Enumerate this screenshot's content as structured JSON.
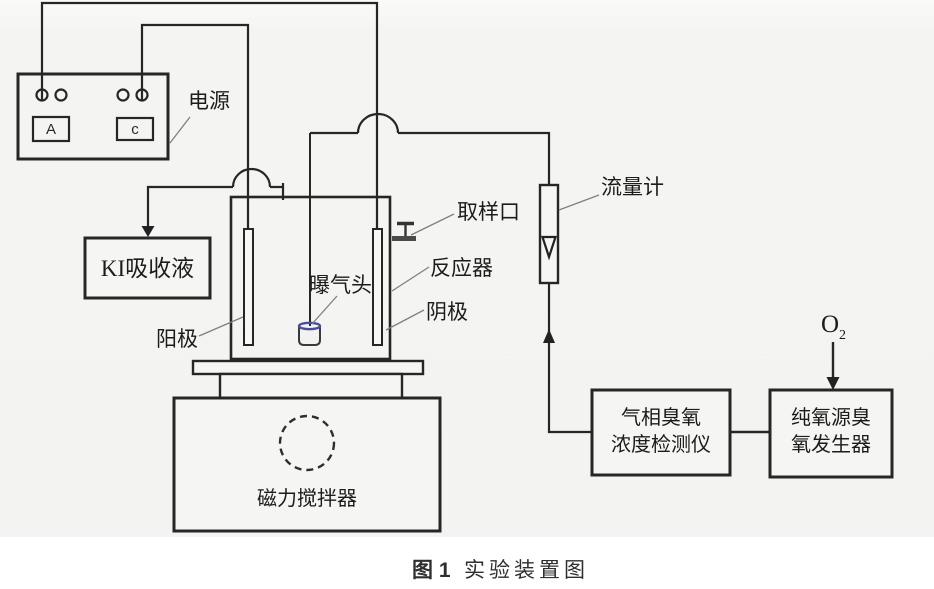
{
  "power_supply": {
    "label": "电源",
    "ammeter_label": "A",
    "meter_c_label": "c"
  },
  "ki_absorber": {
    "label": "KI吸收液"
  },
  "reactor": {
    "label": "反应器",
    "anode_label": "阳极",
    "cathode_label": "阴极",
    "aerator_label": "曝气头",
    "sampling_port_label": "取样口"
  },
  "flow_meter": {
    "label": "流量计"
  },
  "stirrer": {
    "label": "磁力搅拌器"
  },
  "ozone_detector": {
    "label_line1": "气相臭氧",
    "label_line2": "浓度检测仪"
  },
  "ozone_generator": {
    "label_line1": "纯氧源臭",
    "label_line2": "氧发生器"
  },
  "oxygen_inlet": {
    "symbol": "O",
    "subscript": "2"
  },
  "caption": {
    "figure_no": "图 1",
    "title": "实验装置图"
  },
  "colors": {
    "line": "#262626",
    "diagram_bg": "#f4f4f2",
    "page_bg": "#ffffff",
    "aerator_rim": "#4c4c9d",
    "pointer_line": "#808080",
    "arrow_fill": "#222222"
  }
}
